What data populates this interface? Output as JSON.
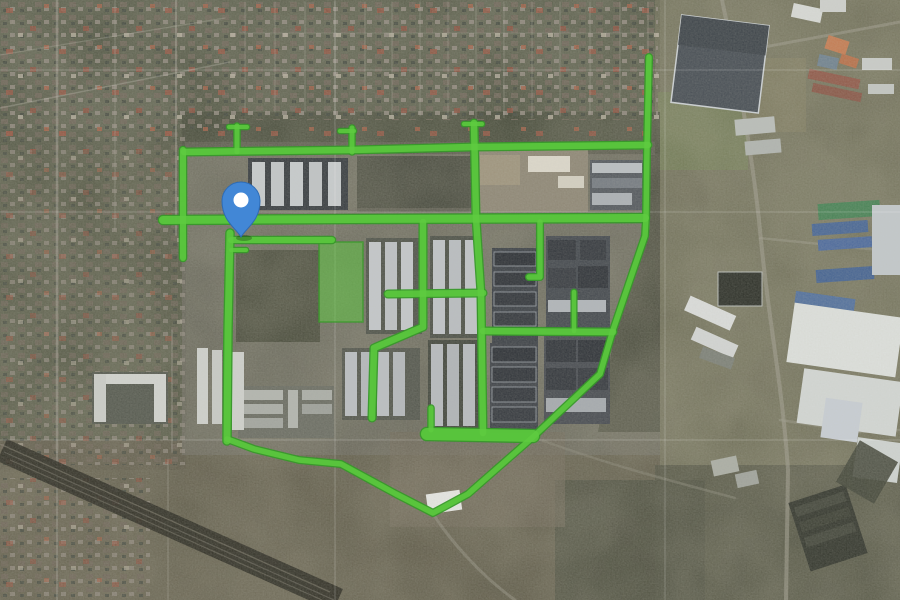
{
  "meta": {
    "description": "Aerial satellite map view with a highlighted green path network over a housing estate and a blue location marker",
    "width": 900,
    "height": 600
  },
  "map": {
    "marker": {
      "tip_x": 241,
      "tip_y": 237,
      "body_color": "#4287d6",
      "border_color": "#2d6bb5",
      "center_dot_color": "#ffffff"
    },
    "route_overlay": {
      "fill_color": "#5ecb40",
      "edge_color": "#38992a",
      "fill_opacity": 0.85,
      "edge_opacity": 0.95,
      "segments": [
        {
          "w": 5.5,
          "pts": [
            [
              649,
              57
            ],
            [
              647,
              147
            ],
            [
              646,
              218
            ],
            [
              645,
              236
            ],
            [
              613,
              330
            ],
            [
              600,
              374
            ],
            [
              533,
              437
            ],
            [
              468,
              494
            ],
            [
              433,
              513
            ],
            [
              396,
              494
            ],
            [
              341,
              464
            ],
            [
              299,
              460
            ],
            [
              254,
              449
            ],
            [
              227,
              439
            ]
          ]
        },
        {
          "w": 7,
          "pts": [
            [
              227,
              441
            ],
            [
              228,
              330
            ],
            [
              230,
              233
            ]
          ]
        },
        {
          "w": 6.5,
          "pts": [
            [
              184,
              152
            ],
            [
              352,
              150
            ],
            [
              472,
              147
            ],
            [
              648,
              145
            ]
          ]
        },
        {
          "w": 8,
          "pts": [
            [
              163,
              220
            ],
            [
              352,
              219
            ],
            [
              645,
              218
            ]
          ]
        },
        {
          "w": 6,
          "pts": [
            [
              231,
              240
            ],
            [
              332,
              240
            ]
          ]
        },
        {
          "w": 5,
          "pts": [
            [
              237,
              126
            ],
            [
              237,
              152
            ]
          ]
        },
        {
          "w": 4,
          "pts": [
            [
              229,
              127
            ],
            [
              247,
              127
            ]
          ]
        },
        {
          "w": 6,
          "pts": [
            [
              183,
              150
            ],
            [
              183,
              258
            ]
          ]
        },
        {
          "w": 5,
          "pts": [
            [
              352,
              128
            ],
            [
              352,
              152
            ]
          ]
        },
        {
          "w": 4,
          "pts": [
            [
              340,
              131
            ],
            [
              354,
              131
            ]
          ]
        },
        {
          "w": 6.5,
          "pts": [
            [
              474,
              123
            ],
            [
              476,
              218
            ],
            [
              481,
              293
            ],
            [
              483,
              433
            ]
          ]
        },
        {
          "w": 4,
          "pts": [
            [
              464,
              124
            ],
            [
              482,
              124
            ]
          ]
        },
        {
          "w": 6.5,
          "pts": [
            [
              423,
              222
            ],
            [
              423,
              327
            ],
            [
              374,
              348
            ],
            [
              372,
              418
            ]
          ]
        },
        {
          "w": 6.5,
          "pts": [
            [
              388,
              294
            ],
            [
              483,
              293
            ]
          ]
        },
        {
          "w": 6.5,
          "pts": [
            [
              483,
              331
            ],
            [
              613,
              332
            ]
          ]
        },
        {
          "w": 4.5,
          "pts": [
            [
              574,
              292
            ],
            [
              574,
              331
            ]
          ]
        },
        {
          "w": 5.5,
          "pts": [
            [
              540,
              222
            ],
            [
              540,
              277
            ],
            [
              529,
              277
            ]
          ]
        },
        {
          "w": 5,
          "pts": [
            [
              431,
              408
            ],
            [
              431,
              430
            ]
          ]
        },
        {
          "w": 12,
          "pts": [
            [
              427,
              434
            ],
            [
              533,
              436
            ]
          ]
        },
        {
          "w": 4,
          "pts": [
            [
              231,
              250
            ],
            [
              246,
              250
            ]
          ]
        }
      ],
      "park_area": {
        "x": 319,
        "y": 242,
        "w": 44,
        "h": 80
      }
    },
    "graticule": {
      "color": "#ffffff",
      "opacity": 0.2,
      "horizontal_y": [
        70,
        212,
        440
      ],
      "vertical_x": [
        335,
        665
      ]
    }
  }
}
